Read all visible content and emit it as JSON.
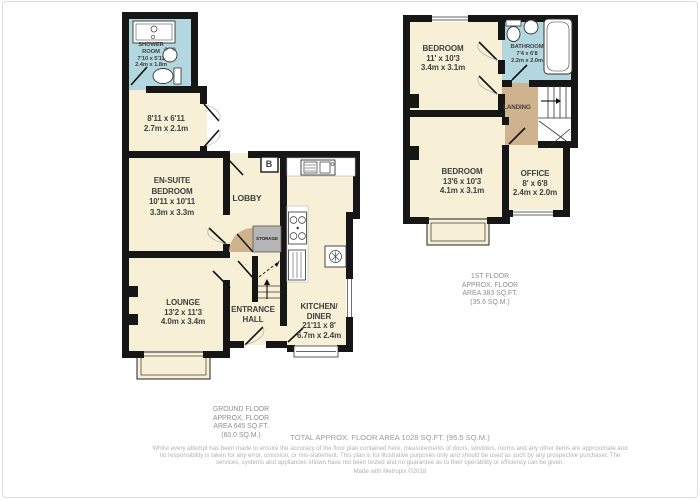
{
  "ground": {
    "shower_room": {
      "lines": [
        "SHOWER",
        "ROOM",
        "7'10 x 5'11",
        "2.4m x 1.8m"
      ]
    },
    "rear_room": {
      "lines": [
        "8'11 x 6'11",
        "2.7m x 2.1m"
      ]
    },
    "ensuite_bedroom": {
      "lines": [
        "EN-SUITE",
        "BEDROOM",
        "10'11 x 10'11",
        "3.3m x 3.3m"
      ]
    },
    "lobby": {
      "lines": [
        "LOBBY"
      ]
    },
    "boiler": {
      "lines": [
        "B"
      ]
    },
    "storage": {
      "lines": [
        "STORAGE"
      ]
    },
    "lounge": {
      "lines": [
        "LOUNGE",
        "13'2 x 11'3",
        "4.0m x 3.4m"
      ]
    },
    "entrance_hall": {
      "lines": [
        "ENTRANCE",
        "HALL"
      ]
    },
    "kitchen_diner": {
      "lines": [
        "KITCHEN/",
        "DINER",
        "21'11 x 8'",
        "6.7m x 2.4m"
      ]
    },
    "area_label": {
      "lines": [
        "GROUND FLOOR",
        "APPROX. FLOOR",
        "AREA 645 SQ.FT.",
        "(60.0 SQ.M.)"
      ]
    }
  },
  "first": {
    "bedroom_front": {
      "lines": [
        "BEDROOM",
        "11' x 10'3",
        "3.4m x 3.1m"
      ]
    },
    "bathroom": {
      "lines": [
        "BATHROOM",
        "7'4 x 6'8",
        "2.2m x 2.0m"
      ]
    },
    "landing": {
      "lines": [
        "LANDING"
      ]
    },
    "bedroom_back": {
      "lines": [
        "BEDROOM",
        "13'6 x 10'3",
        "4.1m x 3.1m"
      ]
    },
    "office": {
      "lines": [
        "OFFICE",
        "8' x 6'8",
        "2.4m x 2.0m"
      ]
    },
    "area_label": {
      "lines": [
        "1ST FLOOR",
        "APPROX. FLOOR",
        "AREA 383 SQ.FT.",
        "(35.6 SQ.M.)"
      ]
    }
  },
  "footer": {
    "total": "TOTAL APPROX. FLOOR AREA 1028 SQ.FT. (95.5 SQ.M.)",
    "disclaimer": "Whilst every attempt has been made to ensure the accuracy of the floor plan contained here, measurements of doors, windows, rooms and any other items are approximate and no responsibility is taken for any error, omission, or mis-statement. This plan is for illustrative purposes only and should be used as such by any prospective purchaser. The services, systems and appliances shown have not been tested and no guarantee as to their operability or efficiency can be given.",
    "credit": "Made with Metropix ©2018"
  },
  "colors": {
    "room_fill": "#f7f0d6",
    "wet_room_fill": "#b3d7de",
    "landing_fill": "#cfb38f",
    "storage_fill": "#b5b5b5",
    "wall": "#161616"
  }
}
